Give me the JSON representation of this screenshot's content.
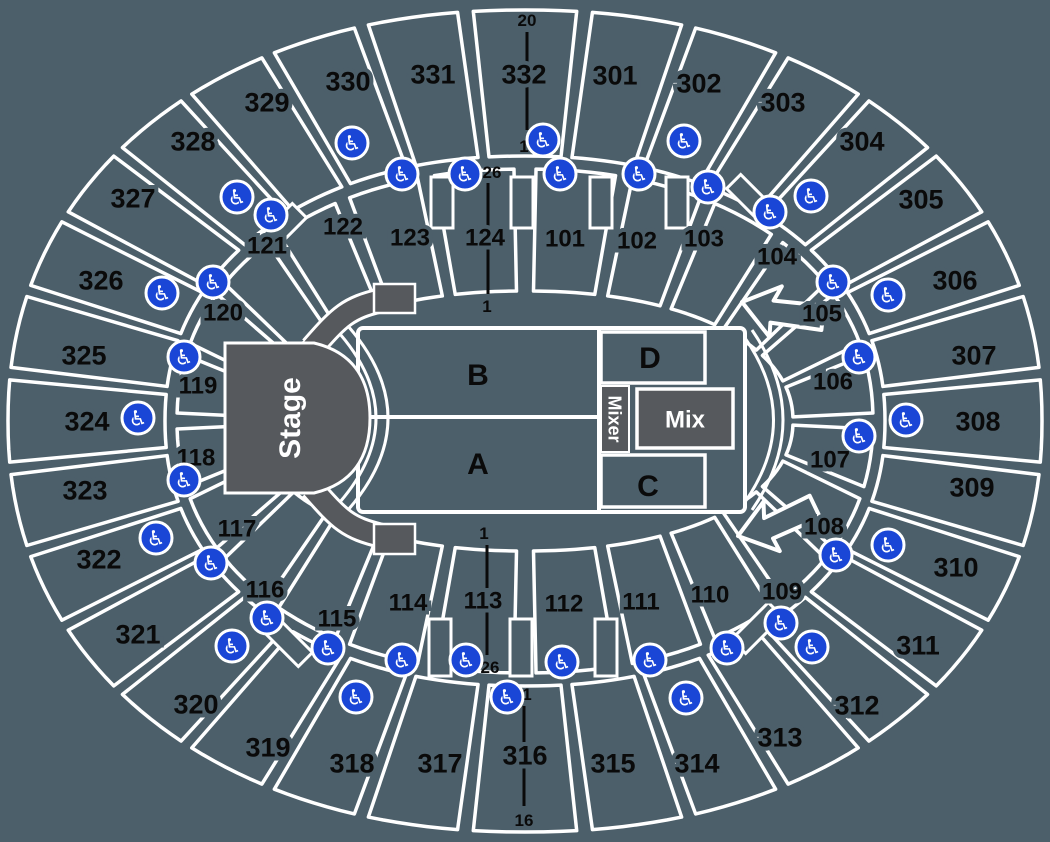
{
  "colors": {
    "background": "#4C5F6A",
    "border": "#FFFFFF",
    "stage_fill": "#56595D",
    "label": "#0A0A0A",
    "wheelchair_blue": "#1A46D6",
    "floor_text": "#FFFFFF"
  },
  "stage": {
    "label": "Stage"
  },
  "mix": {
    "label": "Mix"
  },
  "mixer": {
    "label": "Mixer"
  },
  "floor_zones": [
    {
      "id": "B",
      "x": 478,
      "y": 374
    },
    {
      "id": "A",
      "x": 478,
      "y": 463
    },
    {
      "id": "D",
      "x": 650,
      "y": 357
    },
    {
      "id": "C",
      "x": 648,
      "y": 485
    }
  ],
  "outer_sections": [
    {
      "id": "301",
      "x": 615,
      "y": 75
    },
    {
      "id": "302",
      "x": 699,
      "y": 83
    },
    {
      "id": "303",
      "x": 783,
      "y": 102
    },
    {
      "id": "304",
      "x": 862,
      "y": 141
    },
    {
      "id": "305",
      "x": 921,
      "y": 199
    },
    {
      "id": "306",
      "x": 955,
      "y": 280
    },
    {
      "id": "307",
      "x": 974,
      "y": 355
    },
    {
      "id": "308",
      "x": 978,
      "y": 421
    },
    {
      "id": "309",
      "x": 972,
      "y": 487
    },
    {
      "id": "310",
      "x": 956,
      "y": 567
    },
    {
      "id": "311",
      "x": 918,
      "y": 645
    },
    {
      "id": "312",
      "x": 857,
      "y": 705
    },
    {
      "id": "313",
      "x": 780,
      "y": 737
    },
    {
      "id": "314",
      "x": 697,
      "y": 763
    },
    {
      "id": "315",
      "x": 613,
      "y": 763
    },
    {
      "id": "316",
      "x": 525,
      "y": 755
    },
    {
      "id": "317",
      "x": 440,
      "y": 763
    },
    {
      "id": "318",
      "x": 352,
      "y": 763
    },
    {
      "id": "319",
      "x": 268,
      "y": 747
    },
    {
      "id": "320",
      "x": 196,
      "y": 704
    },
    {
      "id": "321",
      "x": 138,
      "y": 634
    },
    {
      "id": "322",
      "x": 99,
      "y": 559
    },
    {
      "id": "323",
      "x": 85,
      "y": 490
    },
    {
      "id": "324",
      "x": 87,
      "y": 421
    },
    {
      "id": "325",
      "x": 84,
      "y": 355
    },
    {
      "id": "326",
      "x": 101,
      "y": 280
    },
    {
      "id": "327",
      "x": 133,
      "y": 198
    },
    {
      "id": "328",
      "x": 193,
      "y": 141
    },
    {
      "id": "329",
      "x": 267,
      "y": 102
    },
    {
      "id": "330",
      "x": 348,
      "y": 81
    },
    {
      "id": "331",
      "x": 433,
      "y": 74
    },
    {
      "id": "332",
      "x": 524,
      "y": 74
    }
  ],
  "inner_sections": [
    {
      "id": "101",
      "x": 565,
      "y": 238
    },
    {
      "id": "102",
      "x": 637,
      "y": 240
    },
    {
      "id": "103",
      "x": 704,
      "y": 238
    },
    {
      "id": "104",
      "x": 777,
      "y": 256
    },
    {
      "id": "105",
      "x": 822,
      "y": 313
    },
    {
      "id": "106",
      "x": 833,
      "y": 381
    },
    {
      "id": "107",
      "x": 830,
      "y": 459
    },
    {
      "id": "108",
      "x": 824,
      "y": 526
    },
    {
      "id": "109",
      "x": 782,
      "y": 591
    },
    {
      "id": "110",
      "x": 710,
      "y": 594
    },
    {
      "id": "111",
      "x": 641,
      "y": 601
    },
    {
      "id": "112",
      "x": 564,
      "y": 603
    },
    {
      "id": "113",
      "x": 483,
      "y": 600
    },
    {
      "id": "114",
      "x": 408,
      "y": 602
    },
    {
      "id": "115",
      "x": 337,
      "y": 618
    },
    {
      "id": "116",
      "x": 265,
      "y": 589
    },
    {
      "id": "117",
      "x": 237,
      "y": 528
    },
    {
      "id": "118",
      "x": 196,
      "y": 457
    },
    {
      "id": "119",
      "x": 198,
      "y": 385
    },
    {
      "id": "120",
      "x": 223,
      "y": 312
    },
    {
      "id": "121",
      "x": 267,
      "y": 245
    },
    {
      "id": "122",
      "x": 343,
      "y": 226
    },
    {
      "id": "123",
      "x": 410,
      "y": 237
    },
    {
      "id": "124",
      "x": 485,
      "y": 237
    }
  ],
  "row_markers": [
    {
      "section": "332",
      "outer_label": "20",
      "inner_label": "1",
      "outer_pos": [
        527,
        20
      ],
      "inner_pos": [
        524,
        146
      ],
      "line": [
        527,
        32,
        527,
        130
      ]
    },
    {
      "section": "124",
      "outer_label": "26",
      "inner_label": "1",
      "outer_pos": [
        492,
        172
      ],
      "inner_pos": [
        487,
        306
      ],
      "line": [
        488,
        183,
        488,
        294
      ]
    },
    {
      "section": "113",
      "outer_label": "26",
      "inner_label": "1",
      "outer_pos": [
        490,
        667
      ],
      "inner_pos": [
        484,
        533
      ],
      "line": [
        487,
        545,
        487,
        655
      ]
    },
    {
      "section": "316",
      "outer_label": "16",
      "inner_label": "1",
      "outer_pos": [
        524,
        820
      ],
      "inner_pos": [
        527,
        694
      ],
      "line": [
        524,
        706,
        524,
        806
      ]
    }
  ],
  "wheelchair_positions": [
    [
      352,
      143
    ],
    [
      402,
      174
    ],
    [
      465,
      174
    ],
    [
      543,
      140
    ],
    [
      560,
      174
    ],
    [
      639,
      174
    ],
    [
      684,
      141
    ],
    [
      708,
      187
    ],
    [
      770,
      212
    ],
    [
      811,
      196
    ],
    [
      833,
      282
    ],
    [
      888,
      295
    ],
    [
      237,
      197
    ],
    [
      271,
      215
    ],
    [
      213,
      282
    ],
    [
      162,
      293
    ],
    [
      184,
      357
    ],
    [
      138,
      418
    ],
    [
      184,
      480
    ],
    [
      156,
      538
    ],
    [
      859,
      357
    ],
    [
      906,
      420
    ],
    [
      859,
      436
    ],
    [
      836,
      555
    ],
    [
      888,
      545
    ],
    [
      211,
      563
    ],
    [
      267,
      618
    ],
    [
      232,
      646
    ],
    [
      328,
      648
    ],
    [
      402,
      660
    ],
    [
      466,
      660
    ],
    [
      562,
      662
    ],
    [
      650,
      660
    ],
    [
      727,
      648
    ],
    [
      781,
      623
    ],
    [
      812,
      647
    ],
    [
      356,
      697
    ],
    [
      507,
      697
    ],
    [
      686,
      698
    ]
  ]
}
